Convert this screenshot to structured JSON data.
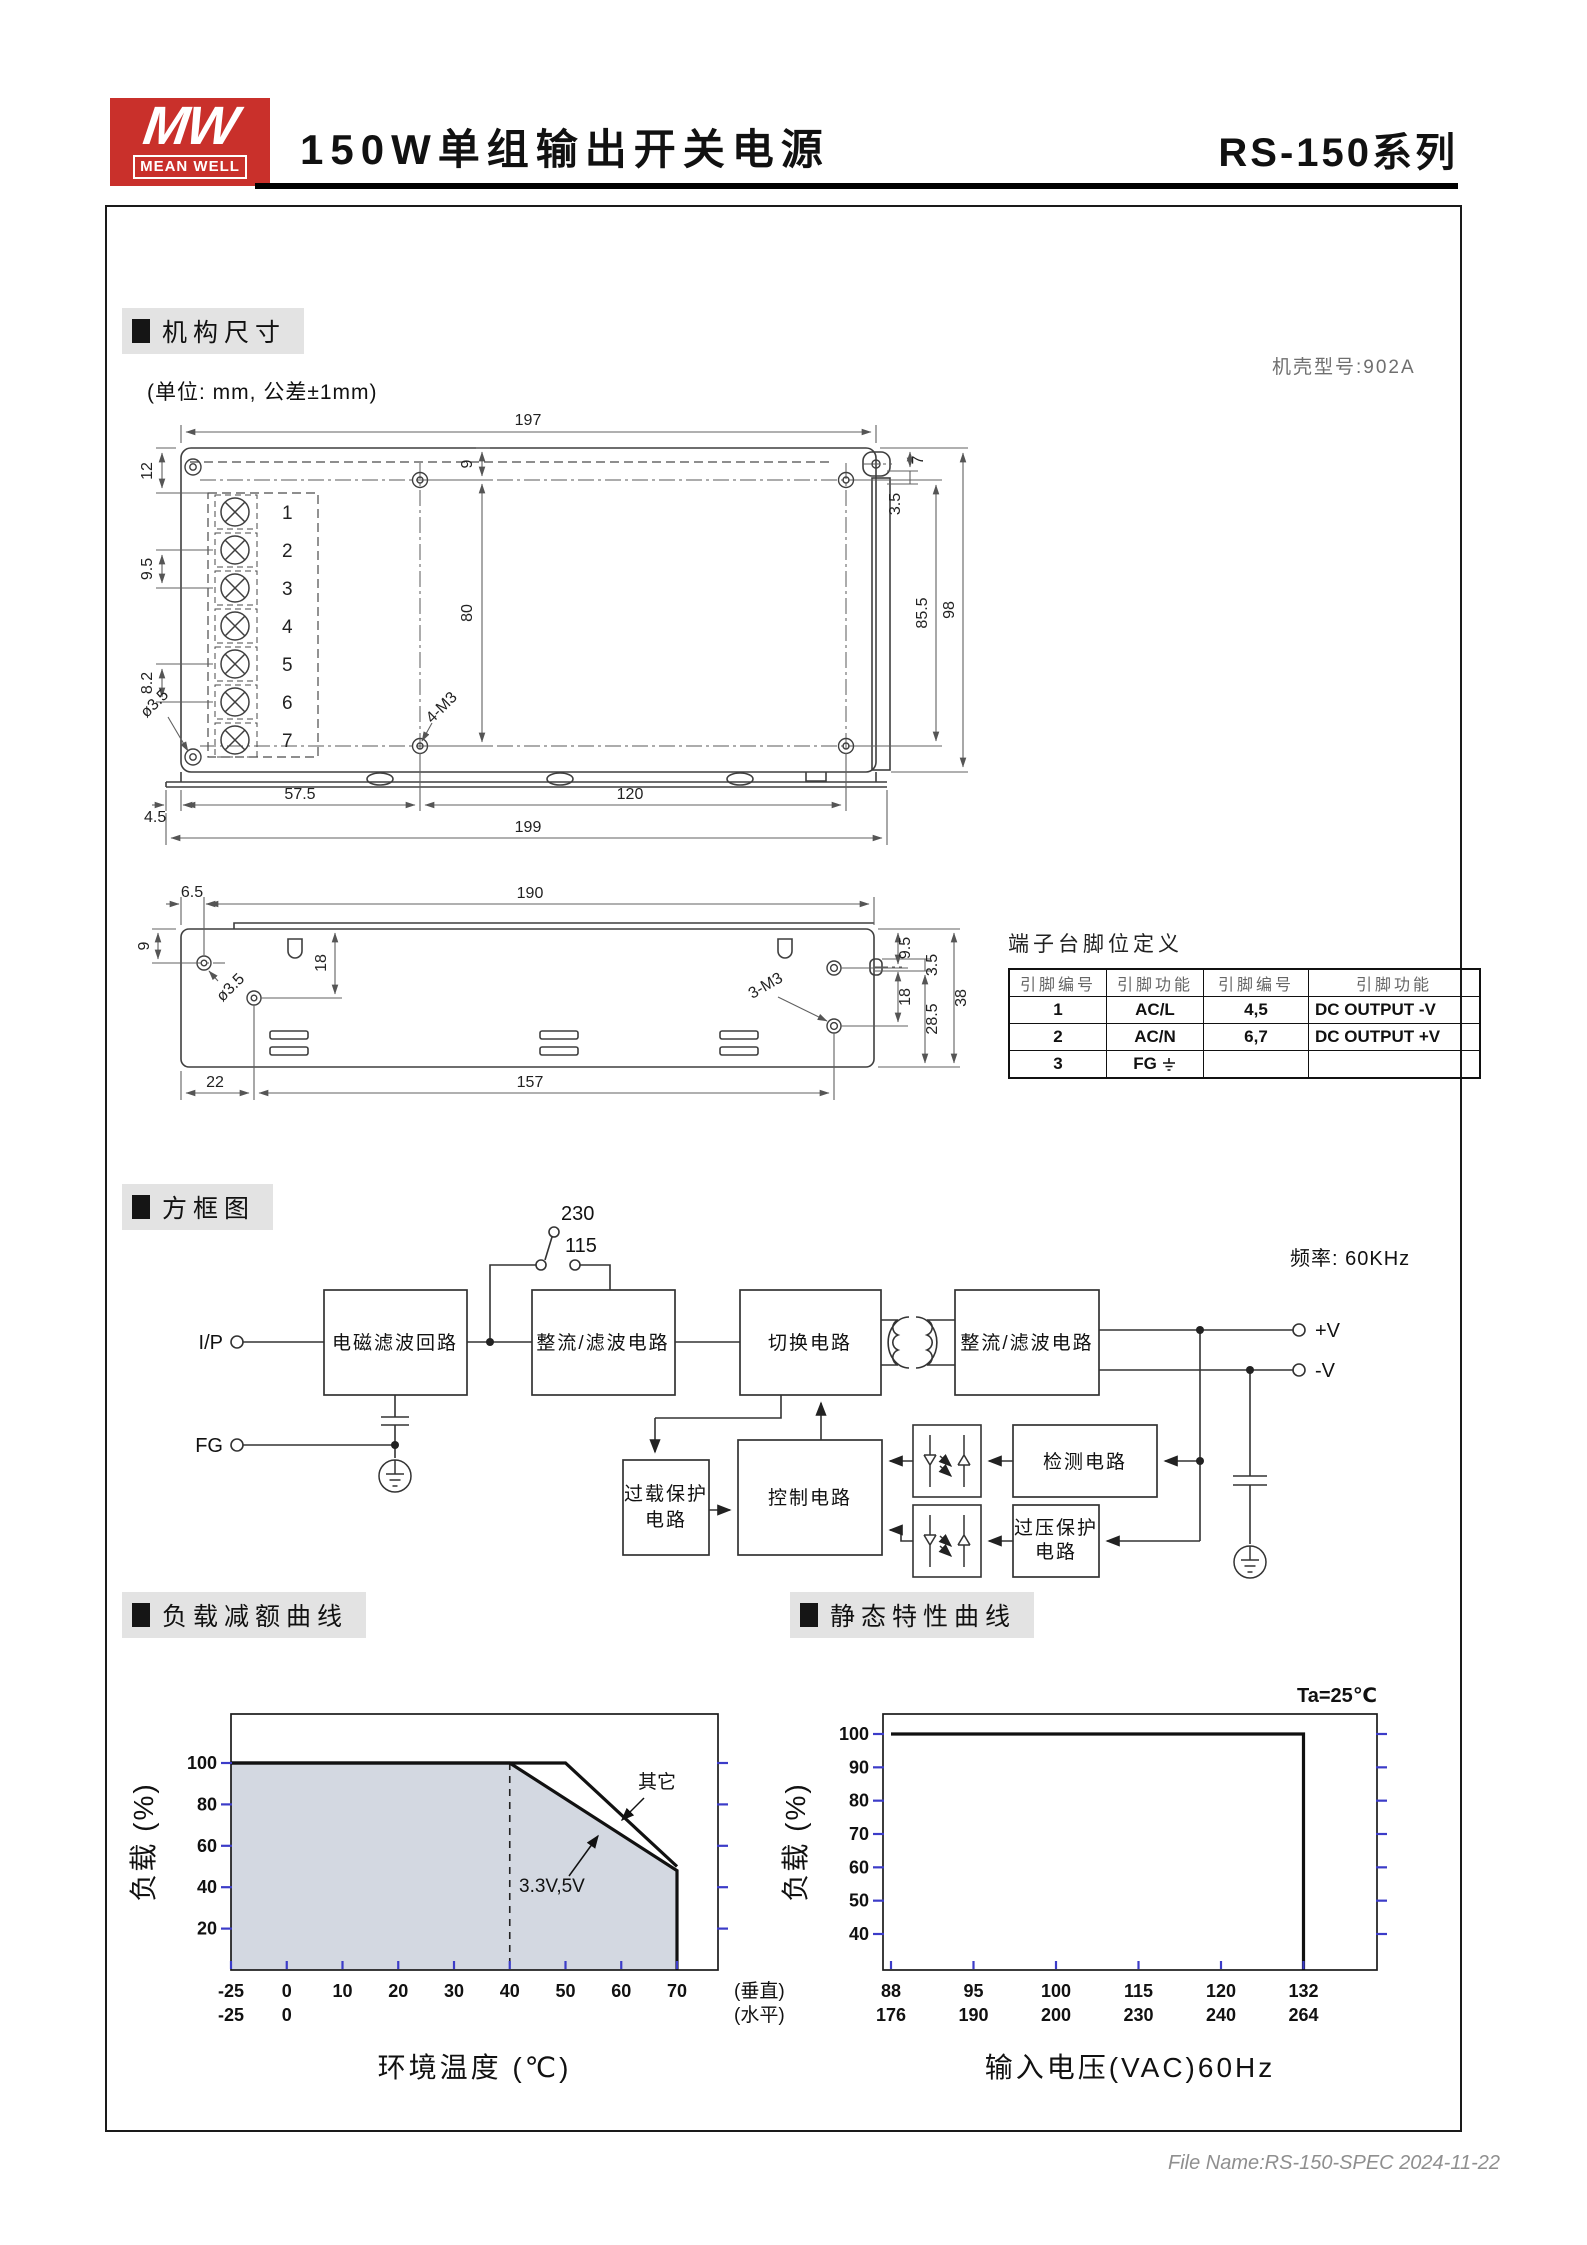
{
  "header": {
    "logo_mw": "MW",
    "logo_brand": "MEAN WELL",
    "title": "150W单组输出开关电源",
    "series": "RS-150系列"
  },
  "mech": {
    "section_title": "机构尺寸",
    "unit_note": "(单位: mm, 公差±1mm)",
    "case_note": "机壳型号:902A",
    "top": {
      "d197": "197",
      "d12": "12",
      "d95": "9.5",
      "d82": "8.2",
      "d9": "9",
      "d80": "80",
      "d855": "85.5",
      "d98": "98",
      "d7": "7",
      "d35": "3.5",
      "hole": "ø3.5",
      "screw": "4-M3",
      "d45": "4.5",
      "d575": "57.5",
      "d120": "120",
      "d199": "199",
      "terminals": [
        "1",
        "2",
        "3",
        "4",
        "5",
        "6",
        "7"
      ]
    },
    "side": {
      "d65": "6.5",
      "d190": "190",
      "d9": "9",
      "d18a": "18",
      "hole": "ø3.5",
      "screw": "3-M3",
      "d95": "9.5",
      "d18b": "18",
      "d35": "3.5",
      "d285": "28.5",
      "d38": "38",
      "d22": "22",
      "d157": "157"
    }
  },
  "pin_table": {
    "title": "端子台脚位定义",
    "headers": [
      "引脚编号",
      "引脚功能",
      "引脚编号",
      "引脚功能"
    ],
    "rows": [
      [
        "1",
        "AC/L",
        "4,5",
        "DC OUTPUT -V"
      ],
      [
        "2",
        "AC/N",
        "6,7",
        "DC OUTPUT +V"
      ],
      [
        "3",
        "FG",
        "",
        ""
      ]
    ]
  },
  "block_diagram": {
    "section_title": "方框图",
    "freq_note": "频率: 60KHz",
    "sw_top": "230",
    "sw_bottom": "115",
    "ip": "I/P",
    "fg": "FG",
    "vplus": "+V",
    "vminus": "-V",
    "emi": "电磁滤波回路",
    "rect1": "整流/滤波电路",
    "sw_block": "切换电路",
    "rect2": "整流/滤波电路",
    "overload1": "过载保护",
    "overload2": "电路",
    "control": "控制电路",
    "detect": "检测电路",
    "ovp1": "过压保护",
    "ovp2": "电路"
  },
  "derating_section": {
    "title": "负载减额曲线"
  },
  "static_section": {
    "title": "静态特性曲线"
  },
  "footer": {
    "file_note": "File Name:RS-150-SPEC  2024-11-22"
  },
  "chart_data": [
    {
      "type": "line",
      "title": "负载减额曲线",
      "xlabel": "环境温度 (℃)",
      "ylabel": "负载 (%)",
      "x_tick_values": [
        -25,
        0,
        10,
        20,
        30,
        40,
        50,
        60,
        70
      ],
      "x_tick_labels": [
        "-25",
        "0",
        "10",
        "20",
        "30",
        "40",
        "50",
        "60",
        "70"
      ],
      "x_tick_labels_row2": [
        "-25",
        "0"
      ],
      "x_suffix_labels": [
        "(垂直)",
        "(水平)"
      ],
      "y_ticks": [
        20,
        40,
        60,
        80,
        100
      ],
      "ylim": [
        0,
        123
      ],
      "grid": false,
      "series": [
        {
          "name": "其它",
          "points": [
            [
              -25,
              100
            ],
            [
              50,
              100
            ],
            [
              70,
              50
            ]
          ]
        },
        {
          "name": "3.3V,5V",
          "points": [
            [
              -25,
              100
            ],
            [
              40,
              100
            ],
            [
              70,
              48
            ]
          ],
          "fill": true,
          "drop_to_zero": true
        }
      ],
      "dashed_vline_x": 40,
      "fill_color": "#d3d8e1",
      "tick_color": "#3c3cc8"
    },
    {
      "type": "line",
      "title": "静态特性曲线",
      "note": "Ta=25℃",
      "xlabel": "输入电压(VAC)60Hz",
      "ylabel": "负载 (%)",
      "x_tick_values": [
        88,
        95,
        100,
        115,
        120,
        132
      ],
      "x_tick_labels": [
        "88",
        "95",
        "100",
        "115",
        "120",
        "132"
      ],
      "x_tick_labels_row2": [
        "176",
        "190",
        "200",
        "230",
        "240",
        "264"
      ],
      "y_ticks": [
        40,
        50,
        60,
        70,
        80,
        90,
        100
      ],
      "ylim": [
        29,
        106
      ],
      "grid": false,
      "series": [
        {
          "name": "负载",
          "points": [
            [
              88,
              100
            ],
            [
              132,
              100
            ]
          ],
          "drop_to_zero": true
        }
      ],
      "tick_color": "#3c3cc8"
    }
  ]
}
